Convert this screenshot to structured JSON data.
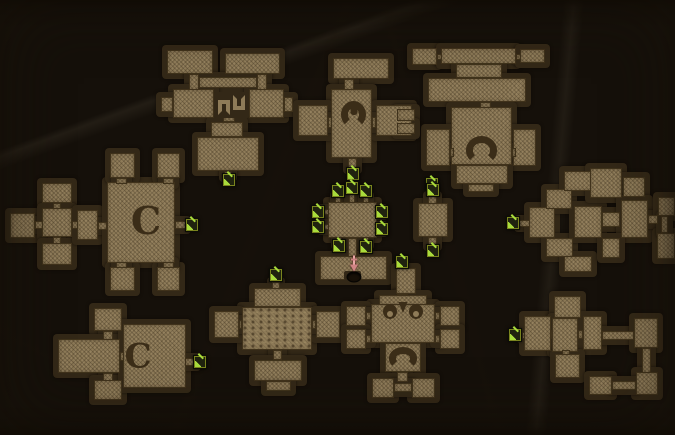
{
  "map": {
    "canvas": {
      "width": 675,
      "height": 435
    },
    "palette": {
      "bg1": "#6f5e41",
      "bg2": "#64533​5",
      "bg3": "#392c17",
      "wall": "#332817",
      "room": "#8e7b58",
      "roomline": "#46381f",
      "ink": "#3b2d18",
      "doorbg": "#20230f",
      "doorline": "#7a841e",
      "arrow": "#a9dc3c",
      "blood": "#d08484",
      "holec": "#171007"
    },
    "clusters": [
      {
        "name": "top-left-dungeon",
        "shapes": [
          [
            167,
            50,
            46,
            24
          ],
          [
            189,
            74,
            10,
            16
          ],
          [
            225,
            53,
            55,
            21
          ],
          [
            257,
            74,
            10,
            16
          ],
          [
            199,
            77,
            58,
            11
          ],
          [
            173,
            89,
            41,
            29
          ],
          [
            161,
            97,
            12,
            15
          ],
          [
            249,
            89,
            35,
            29
          ],
          [
            284,
            97,
            9,
            15
          ],
          [
            223,
            116,
            12,
            6
          ],
          [
            211,
            122,
            32,
            15
          ],
          [
            197,
            137,
            62,
            34
          ],
          [
            224,
            171,
            8,
            6
          ]
        ],
        "decor": [
          {
            "t": "hooks",
            "x": 214,
            "y": 92,
            "w": 35,
            "h": 26
          }
        ],
        "markers": [
          {
            "t": "door",
            "x": 229,
            "y": 180
          }
        ]
      },
      {
        "name": "top-mid-dungeon",
        "shapes": [
          [
            333,
            58,
            56,
            21
          ],
          [
            344,
            79,
            10,
            11
          ],
          [
            331,
            89,
            41,
            69
          ],
          [
            298,
            105,
            30,
            31
          ],
          [
            328,
            117,
            4,
            11
          ],
          [
            376,
            105,
            36,
            31
          ],
          [
            372,
            117,
            4,
            11
          ],
          [
            348,
            158,
            9,
            11
          ]
        ],
        "decor": [
          {
            "t": "ring",
            "x": 341,
            "y": 101,
            "w": 25,
            "h": 27
          }
        ],
        "markers": [
          {
            "t": "door",
            "x": 353,
            "y": 174
          }
        ]
      },
      {
        "name": "top-right-dungeon",
        "shapes": [
          [
            412,
            48,
            25,
            17
          ],
          [
            437,
            54,
            5,
            6
          ],
          [
            441,
            48,
            75,
            16
          ],
          [
            516,
            54,
            5,
            6
          ],
          [
            520,
            49,
            25,
            14
          ],
          [
            456,
            64,
            46,
            14
          ],
          [
            428,
            78,
            98,
            24
          ],
          [
            480,
            102,
            11,
            6
          ],
          [
            451,
            107,
            61,
            58
          ],
          [
            426,
            129,
            24,
            37
          ],
          [
            450,
            148,
            4,
            9
          ],
          [
            513,
            129,
            23,
            37
          ],
          [
            512,
            148,
            4,
            9
          ],
          [
            456,
            165,
            52,
            19
          ],
          [
            468,
            184,
            26,
            8
          ]
        ],
        "decor": [
          {
            "t": "shoe",
            "x": 466,
            "y": 136,
            "w": 31,
            "h": 28
          }
        ],
        "markers": [
          {
            "t": "door",
            "x": 432,
            "y": 184
          }
        ]
      },
      {
        "name": "mini-pair-rooms",
        "shapes": [
          [
            397,
            109,
            18,
            12
          ],
          [
            397,
            123,
            18,
            11
          ]
        ],
        "decor": [],
        "markers": []
      },
      {
        "name": "mid-left-dungeon",
        "shapes": [
          [
            42,
            183,
            30,
            20
          ],
          [
            53,
            203,
            8,
            6
          ],
          [
            10,
            213,
            25,
            25
          ],
          [
            35,
            221,
            8,
            8
          ],
          [
            42,
            208,
            30,
            29
          ],
          [
            53,
            237,
            8,
            7
          ],
          [
            42,
            243,
            30,
            22
          ],
          [
            72,
            221,
            6,
            8
          ],
          [
            77,
            210,
            21,
            30
          ],
          [
            98,
            222,
            9,
            8
          ],
          [
            107,
            182,
            68,
            81
          ],
          [
            110,
            153,
            25,
            25
          ],
          [
            157,
            153,
            23,
            25
          ],
          [
            116,
            178,
            11,
            6
          ],
          [
            163,
            178,
            11,
            6
          ],
          [
            110,
            267,
            25,
            24
          ],
          [
            157,
            267,
            23,
            24
          ],
          [
            116,
            262,
            11,
            6
          ],
          [
            163,
            262,
            11,
            6
          ],
          [
            175,
            221,
            11,
            8
          ]
        ],
        "decor": [
          {
            "t": "letter",
            "ch": "C",
            "x": 146,
            "y": 222,
            "fs": 38
          }
        ],
        "markers": [
          {
            "t": "door",
            "x": 192,
            "y": 225
          }
        ]
      },
      {
        "name": "center-hub",
        "shapes": [
          [
            328,
            202,
            49,
            36
          ],
          [
            335,
            196,
            6,
            7
          ],
          [
            349,
            194,
            6,
            9
          ],
          [
            363,
            196,
            6,
            7
          ],
          [
            322,
            209,
            7,
            6
          ],
          [
            322,
            224,
            7,
            6
          ],
          [
            376,
            209,
            7,
            6
          ],
          [
            376,
            226,
            7,
            6
          ],
          [
            336,
            237,
            6,
            8
          ],
          [
            363,
            237,
            6,
            8
          ],
          [
            348,
            238,
            9,
            19
          ],
          [
            320,
            256,
            67,
            24
          ]
        ],
        "decor": [
          {
            "t": "notch",
            "x": 344,
            "y": 271,
            "w": 17,
            "h": 9
          }
        ],
        "markers": [
          {
            "t": "door",
            "x": 338,
            "y": 191
          },
          {
            "t": "door",
            "x": 352,
            "y": 188
          },
          {
            "t": "door",
            "x": 366,
            "y": 191
          },
          {
            "t": "door",
            "x": 318,
            "y": 212
          },
          {
            "t": "door",
            "x": 318,
            "y": 227
          },
          {
            "t": "door",
            "x": 382,
            "y": 212
          },
          {
            "t": "door",
            "x": 382,
            "y": 229
          },
          {
            "t": "door",
            "x": 339,
            "y": 246
          },
          {
            "t": "door",
            "x": 366,
            "y": 247
          },
          {
            "t": "start",
            "x": 354,
            "y": 264
          },
          {
            "t": "hole",
            "x": 354,
            "y": 277
          }
        ]
      },
      {
        "name": "right-single-room",
        "shapes": [
          [
            418,
            203,
            30,
            34
          ],
          [
            428,
            196,
            9,
            8
          ],
          [
            428,
            237,
            9,
            9
          ]
        ],
        "decor": [],
        "markers": [
          {
            "t": "door",
            "x": 433,
            "y": 190
          },
          {
            "t": "door",
            "x": 433,
            "y": 251
          }
        ]
      },
      {
        "name": "far-right-dungeon",
        "shapes": [
          [
            519,
            220,
            11,
            7
          ],
          [
            529,
            207,
            26,
            31
          ],
          [
            546,
            189,
            26,
            20
          ],
          [
            546,
            238,
            27,
            19
          ],
          [
            564,
            171,
            28,
            20
          ],
          [
            564,
            256,
            28,
            16
          ],
          [
            574,
            206,
            28,
            32
          ],
          [
            590,
            168,
            32,
            30
          ],
          [
            623,
            177,
            22,
            20
          ],
          [
            602,
            212,
            18,
            15
          ],
          [
            621,
            200,
            27,
            38
          ],
          [
            648,
            215,
            10,
            9
          ],
          [
            658,
            197,
            17,
            19
          ],
          [
            657,
            233,
            18,
            26
          ],
          [
            661,
            216,
            7,
            17
          ],
          [
            602,
            238,
            18,
            20
          ]
        ],
        "decor": [],
        "markers": [
          {
            "t": "door",
            "x": 513,
            "y": 223
          }
        ]
      },
      {
        "name": "bottom-midleft-dungeon",
        "shapes": [
          [
            272,
            282,
            8,
            8
          ],
          [
            254,
            288,
            47,
            19
          ],
          [
            242,
            307,
            70,
            43,
            "s"
          ],
          [
            214,
            311,
            25,
            27
          ],
          [
            239,
            320,
            3,
            9
          ],
          [
            316,
            311,
            24,
            27
          ],
          [
            312,
            320,
            4,
            9
          ],
          [
            273,
            350,
            9,
            10
          ],
          [
            254,
            360,
            48,
            21
          ],
          [
            266,
            381,
            25,
            10
          ]
        ],
        "decor": [],
        "markers": [
          {
            "t": "door",
            "x": 276,
            "y": 275
          }
        ]
      },
      {
        "name": "bottom-mid-dungeon",
        "shapes": [
          [
            396,
            268,
            20,
            26
          ],
          [
            397,
            294,
            11,
            10
          ],
          [
            379,
            295,
            48,
            10
          ],
          [
            371,
            304,
            64,
            39
          ],
          [
            346,
            306,
            20,
            20
          ],
          [
            366,
            312,
            5,
            8
          ],
          [
            346,
            329,
            20,
            20
          ],
          [
            366,
            335,
            5,
            8
          ],
          [
            440,
            306,
            20,
            20
          ],
          [
            435,
            312,
            5,
            8
          ],
          [
            440,
            329,
            20,
            20
          ],
          [
            435,
            335,
            5,
            8
          ],
          [
            385,
            343,
            36,
            29
          ],
          [
            397,
            372,
            11,
            10
          ],
          [
            372,
            378,
            22,
            20
          ],
          [
            412,
            378,
            23,
            20
          ],
          [
            394,
            383,
            18,
            9
          ]
        ],
        "decor": [
          {
            "t": "face",
            "x": 382,
            "y": 301,
            "w": 42,
            "h": 22
          },
          {
            "t": "shoe",
            "x": 389,
            "y": 347,
            "w": 28,
            "h": 22
          }
        ],
        "markers": [
          {
            "t": "door",
            "x": 402,
            "y": 262
          }
        ]
      },
      {
        "name": "bottom-left-dungeon",
        "shapes": [
          [
            94,
            308,
            28,
            23
          ],
          [
            103,
            331,
            10,
            9
          ],
          [
            58,
            339,
            62,
            34
          ],
          [
            120,
            352,
            5,
            9
          ],
          [
            103,
            373,
            10,
            9
          ],
          [
            94,
            380,
            28,
            20
          ],
          [
            123,
            324,
            63,
            64
          ],
          [
            185,
            358,
            11,
            8
          ]
        ],
        "decor": [
          {
            "t": "letter",
            "ch": "C",
            "x": 138,
            "y": 357,
            "fs": 34
          }
        ],
        "markers": [
          {
            "t": "door",
            "x": 200,
            "y": 362
          }
        ]
      },
      {
        "name": "bottom-right-dungeon",
        "shapes": [
          [
            522,
            332,
            6,
            7
          ],
          [
            524,
            316,
            27,
            35
          ],
          [
            551,
            330,
            5,
            9
          ],
          [
            554,
            296,
            27,
            22
          ],
          [
            552,
            318,
            26,
            34
          ],
          [
            578,
            330,
            5,
            9
          ],
          [
            583,
            316,
            19,
            34
          ],
          [
            562,
            350,
            8,
            6
          ],
          [
            555,
            354,
            25,
            24
          ],
          [
            602,
            331,
            32,
            9
          ],
          [
            634,
            318,
            24,
            30
          ],
          [
            642,
            348,
            9,
            25
          ],
          [
            636,
            372,
            22,
            23
          ],
          [
            589,
            376,
            23,
            19
          ],
          [
            612,
            381,
            24,
            9
          ]
        ],
        "decor": [],
        "markers": [
          {
            "t": "door",
            "x": 515,
            "y": 335
          }
        ]
      }
    ]
  }
}
